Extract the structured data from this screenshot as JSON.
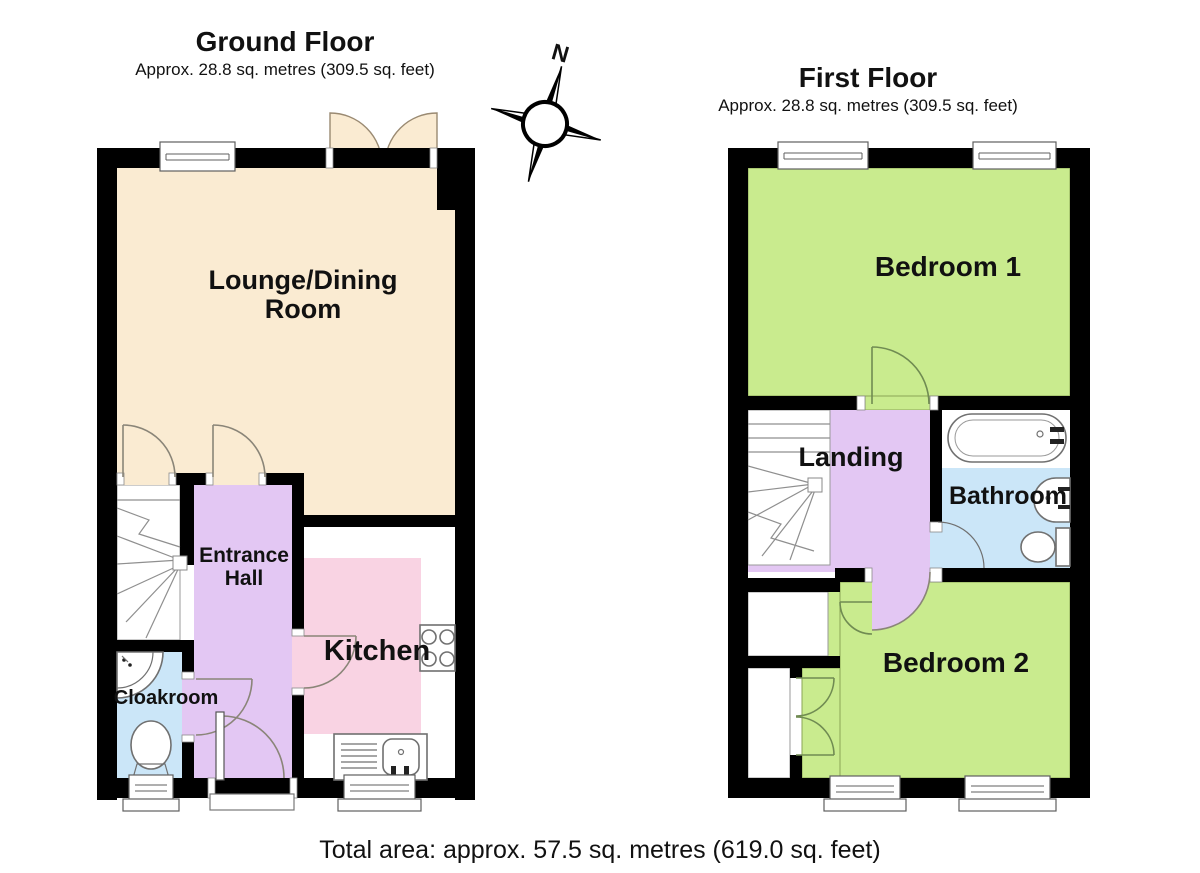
{
  "ground_floor": {
    "title": "Ground Floor",
    "subtitle": "Approx. 28.8 sq. metres (309.5 sq. feet)",
    "rooms": {
      "lounge": "Lounge/Dining Room",
      "entrance_hall": "Entrance Hall",
      "kitchen": "Kitchen",
      "cloakroom": "Cloakroom"
    }
  },
  "first_floor": {
    "title": "First Floor",
    "subtitle": "Approx. 28.8 sq. metres (309.5 sq. feet)",
    "rooms": {
      "bedroom1": "Bedroom 1",
      "landing": "Landing",
      "bathroom": "Bathroom",
      "bedroom2": "Bedroom 2"
    }
  },
  "compass": {
    "north_label": "N"
  },
  "footer": {
    "total_area": "Total area: approx. 57.5 sq. metres (619.0 sq. feet)"
  },
  "colors": {
    "cream": "#faebd2",
    "purple": "#e3c7f3",
    "pink": "#f9d3e3",
    "blue": "#cbe6f8",
    "green": "#c9eb8e",
    "wall": "#000000"
  }
}
